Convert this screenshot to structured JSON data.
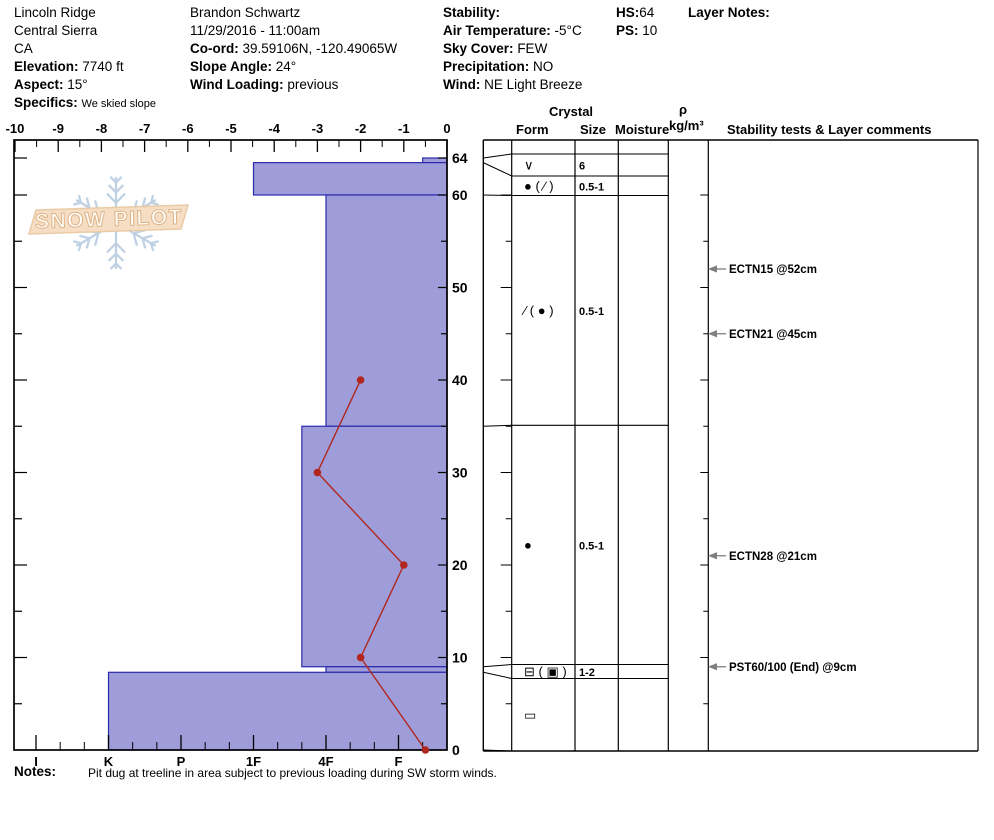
{
  "header": {
    "location": {
      "name": "Lincoln Ridge",
      "region": "Central Sierra",
      "state": "CA",
      "elevation_label": "Elevation:",
      "elevation": "7740 ft",
      "aspect_label": "Aspect:",
      "aspect": "15°",
      "specifics_label": "Specifics:",
      "specifics": "We skied slope"
    },
    "observer": {
      "name": "Brandon Schwartz",
      "datetime": "11/29/2016 - 11:00am",
      "coord_label": "Co-ord:",
      "coord": "39.59106N, -120.49065W",
      "slope_angle_label": "Slope Angle:",
      "slope_angle": "24°",
      "wind_loading_label": "Wind Loading:",
      "wind_loading": "previous"
    },
    "conditions": {
      "stability_label": "Stability:",
      "stability": "",
      "air_temp_label": "Air Temperature:",
      "air_temp": "-5°C",
      "sky_label": "Sky Cover:",
      "sky": "FEW",
      "precip_label": "Precipitation:",
      "precip": "NO",
      "wind_label": "Wind:",
      "wind": "NE Light Breeze"
    },
    "totals": {
      "hs_label": "HS:",
      "hs": "64",
      "ps_label": "PS:",
      "ps": "10"
    },
    "layer_notes_label": "Layer Notes:"
  },
  "logo": {
    "text": "SNOW PILOT"
  },
  "crystal_table": {
    "header_crystal": "Crystal",
    "header_form": "Form",
    "header_size": "Size",
    "header_moisture": "Moisture",
    "header_density": "ρ",
    "header_density_units": "kg/m³",
    "header_comments": "Stability tests & Layer comments"
  },
  "chart_data": [
    {
      "type": "bar",
      "title": "Hand hardness profile (horizontal bars vs depth)",
      "categories": [
        "I",
        "K",
        "P",
        "1F",
        "4F",
        "F"
      ],
      "depth_ticks": [
        0,
        10,
        20,
        30,
        40,
        50,
        60,
        64
      ],
      "depth_range_cm": [
        0,
        64
      ],
      "layers": [
        {
          "top_cm": 64,
          "bottom_cm": 63.5,
          "hardness": "F-",
          "form": "∨",
          "size_mm": "6",
          "moisture": ""
        },
        {
          "top_cm": 63.5,
          "bottom_cm": 60,
          "hardness": "1F",
          "form": "● ( ⁄ )",
          "size_mm": "0.5-1",
          "moisture": ""
        },
        {
          "top_cm": 60,
          "bottom_cm": 35,
          "hardness": "4F",
          "form": "∕ ( ● )",
          "size_mm": "0.5-1",
          "moisture": ""
        },
        {
          "top_cm": 35,
          "bottom_cm": 9,
          "hardness": "4F+",
          "form": "●",
          "size_mm": "0.5-1",
          "moisture": ""
        },
        {
          "top_cm": 9,
          "bottom_cm": 8.4,
          "hardness": "4F",
          "form": "⊟ ( ▣ )",
          "size_mm": "1-2",
          "moisture": ""
        },
        {
          "top_cm": 8.4,
          "bottom_cm": 0,
          "hardness": "K",
          "form": "▭",
          "size_mm": "",
          "moisture": ""
        }
      ]
    },
    {
      "type": "line",
      "title": "Snow temperature profile",
      "xlabel": "Temperature (°C)",
      "x_range": [
        -10,
        0
      ],
      "x_ticks": [
        -10,
        -9,
        -8,
        -7,
        -6,
        -5,
        -4,
        -3,
        -2,
        -1,
        0
      ],
      "points": [
        {
          "depth_cm": 40,
          "temp_c": -2
        },
        {
          "depth_cm": 30,
          "temp_c": -3
        },
        {
          "depth_cm": 20,
          "temp_c": -1
        },
        {
          "depth_cm": 10,
          "temp_c": -2
        },
        {
          "depth_cm": 0,
          "temp_c": -0.5
        }
      ]
    }
  ],
  "stability_tests": [
    {
      "label": "ECTN15 @52cm",
      "depth_cm": 52
    },
    {
      "label": "ECTN21 @45cm",
      "depth_cm": 45
    },
    {
      "label": "ECTN28 @21cm",
      "depth_cm": 21
    },
    {
      "label": "PST60/100 (End) @9cm",
      "depth_cm": 9
    }
  ],
  "notes": {
    "label": "Notes:",
    "text": "Pit dug at treeline in area subject to previous loading during SW storm winds."
  },
  "colors": {
    "bar_fill": "#9e9dd9",
    "bar_border": "#2a2aad",
    "temp_line": "#b1271f",
    "grid": "#000000",
    "arrow_gray": "#7f7f7f",
    "logo_flake": "#bfd1e2",
    "logo_banner_fill": "#f6dec4",
    "logo_banner_stroke": "#e9cba6",
    "logo_text_fill": "#fffdf8",
    "logo_text_stroke": "#ddb489"
  }
}
